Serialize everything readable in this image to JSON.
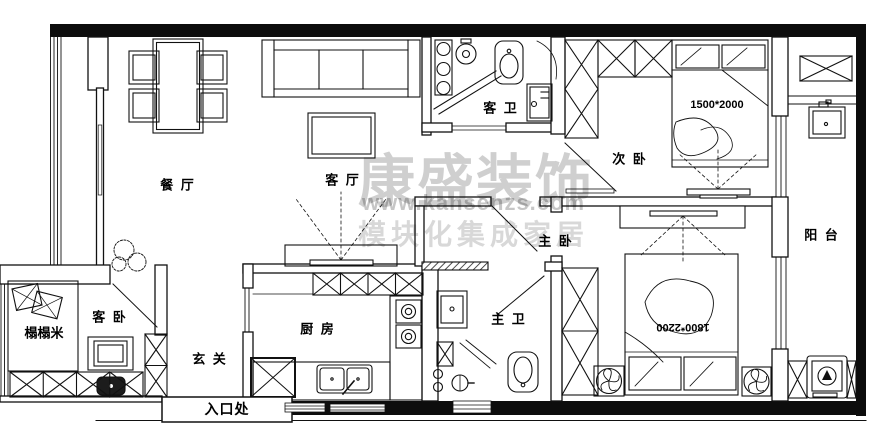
{
  "watermark": {
    "brand": "康盛装饰",
    "url": "www.kansenzs.com",
    "tagline": "模块化集成家居"
  },
  "rooms": {
    "dining": {
      "label": "餐 厅"
    },
    "living": {
      "label": "客 厅"
    },
    "guest_bath": {
      "label": "客 卫"
    },
    "second_bedroom": {
      "label": "次 卧",
      "bed_size": "1500*2000"
    },
    "master_bedroom": {
      "label": "主 卧",
      "bed_size": "1800*2200"
    },
    "master_bath": {
      "label": "主 卫"
    },
    "kitchen": {
      "label": "厨 房"
    },
    "hallway": {
      "label": "玄 关"
    },
    "guest_bedroom": {
      "label": "客 卧"
    },
    "tatami": {
      "label": "榻榻米"
    },
    "balcony": {
      "label": "阳 台"
    },
    "entrance": {
      "label": "入口处"
    }
  },
  "colors": {
    "line": "#111111",
    "background": "#ffffff",
    "watermark": "#b5b5b5"
  }
}
